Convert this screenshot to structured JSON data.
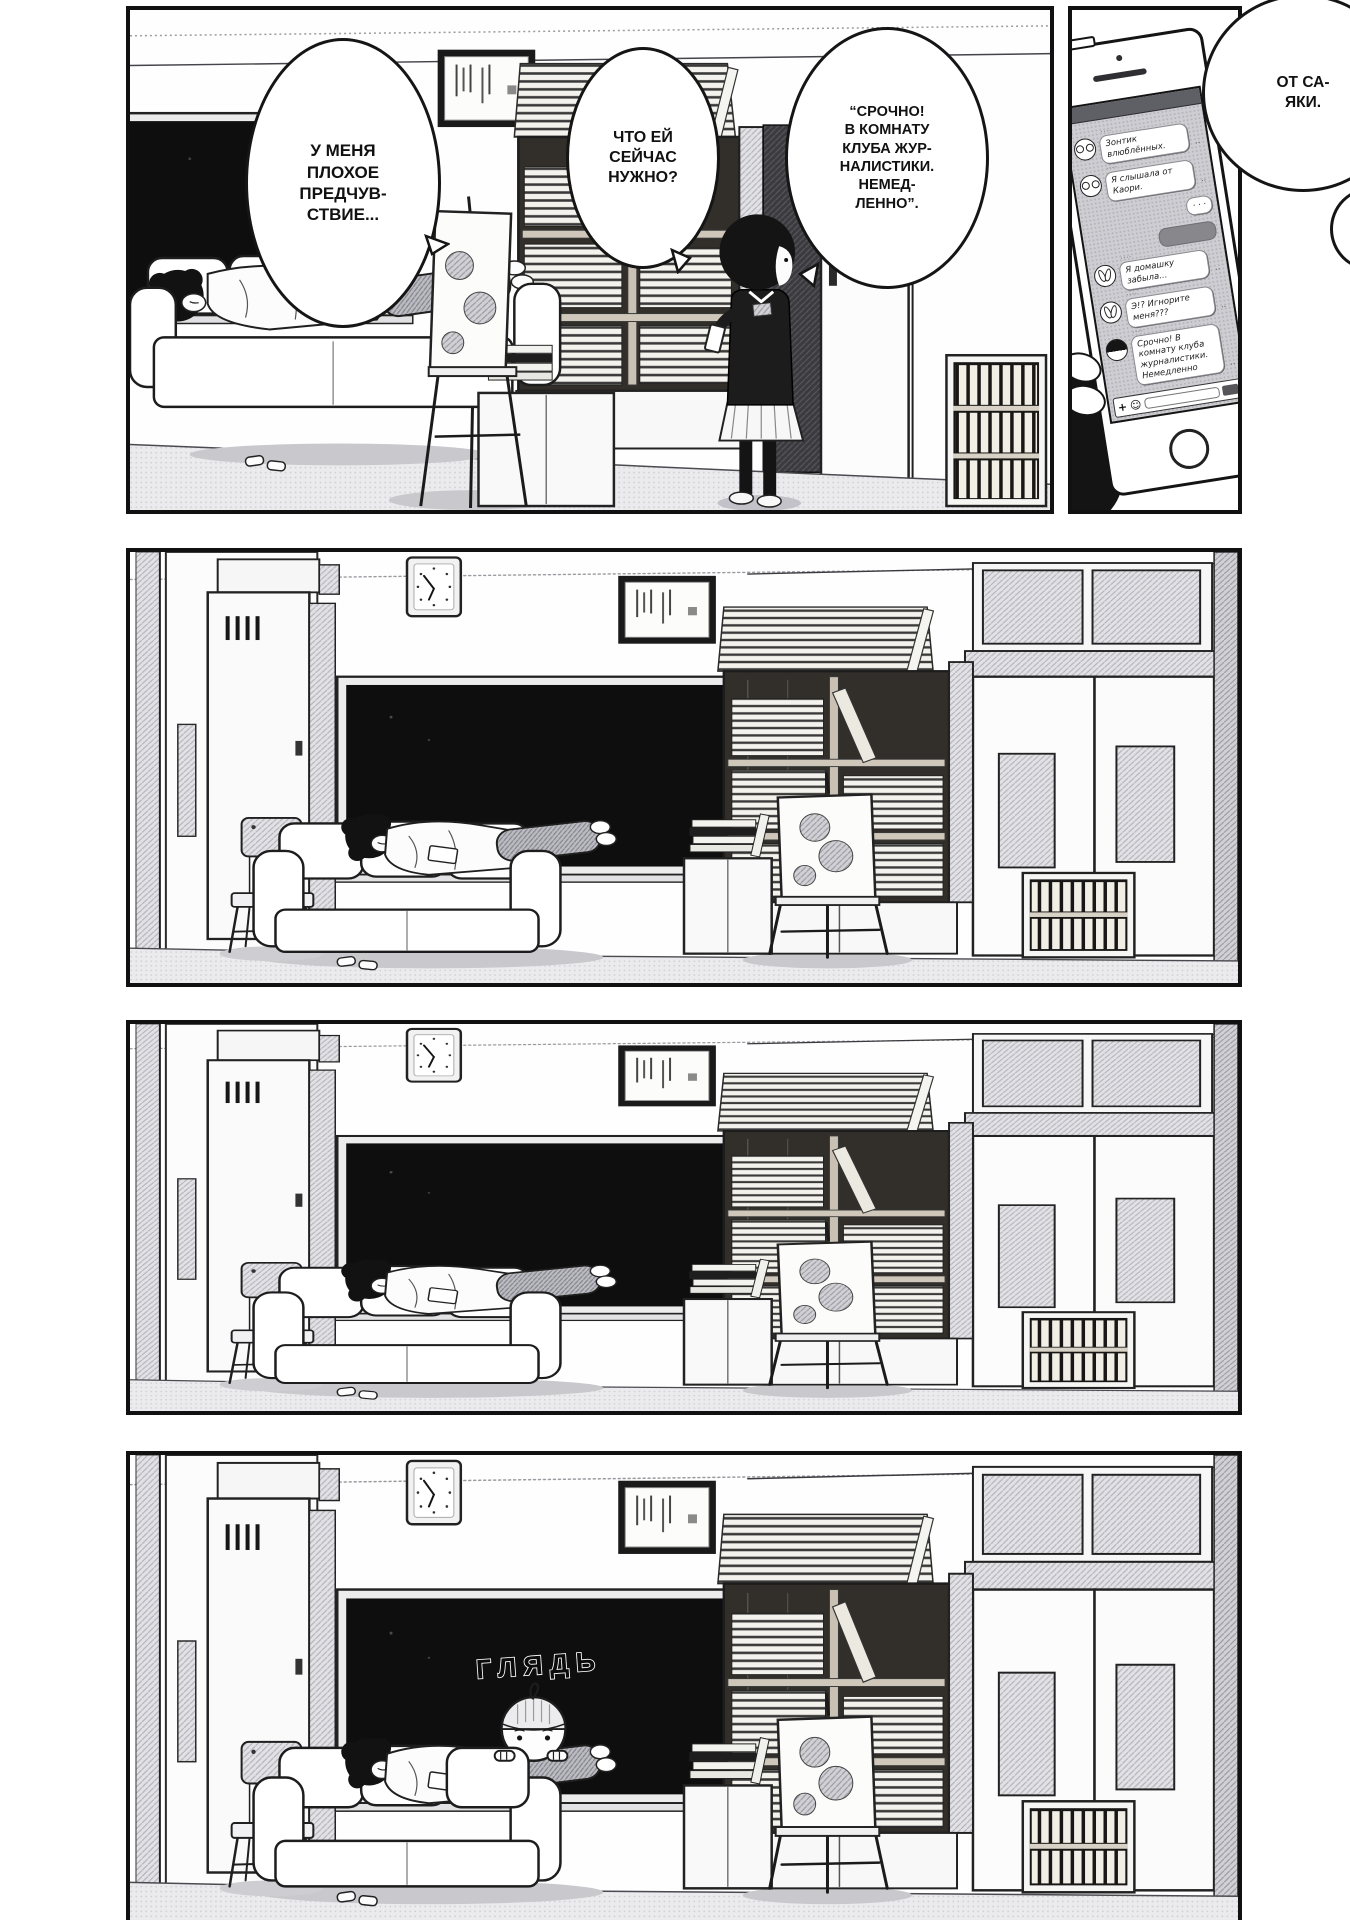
{
  "comic": {
    "bubbles": {
      "premonition": "У МЕНЯ\nПЛОХОЕ\nПРЕДЧУВ-\nСТВИЕ...",
      "what_does_she_need": "ЧТО ЕЙ\nСЕЙЧАС\nНУЖНО?",
      "urgent_message_quote": "“СРОЧНО!\nВ КОМНАТУ\nКЛУБА ЖУР-\nНАЛИСТИКИ.\nНЕМЕД-\nЛЕННО”.",
      "from_sayaka": "ОТ СА-\nЯКИ."
    },
    "sfx": {
      "peek": "ГЛЯДЬ"
    }
  },
  "phone": {
    "messages": [
      {
        "row_class": "msg-row left",
        "avatar_class": "avatar glasses",
        "avatar_icon": "glasses-avatar",
        "text": "Зонтик влюблённых."
      },
      {
        "row_class": "msg-row left",
        "avatar_class": "avatar glasses",
        "avatar_icon": "glasses-avatar",
        "text": "Я слышала от Каори."
      },
      {
        "row_class": "msg-row right",
        "avatar_class": "avatar hidden",
        "avatar_icon": "none",
        "text": "· · ·"
      },
      {
        "row_class": "msg-row right redacted",
        "avatar_class": "avatar hidden",
        "avatar_icon": "none",
        "text": ""
      },
      {
        "row_class": "msg-row left",
        "avatar_class": "avatar bunny",
        "avatar_icon": "bunny-ears-avatar",
        "text": "Я домашку забыла..."
      },
      {
        "row_class": "msg-row left",
        "avatar_class": "avatar bunny",
        "avatar_icon": "bunny-ears-avatar",
        "text": "Э!? Игнорите меня???"
      },
      {
        "row_class": "msg-row left",
        "avatar_class": "avatar darkhair",
        "avatar_icon": "dark-bob-hair-avatar",
        "text": "Срочно! В комнату клуба журналистики. Немедленно"
      }
    ],
    "composer": {
      "plus": "+",
      "emoji": "☺"
    }
  },
  "colors": {
    "ink": "#141414",
    "paper": "#ffffff",
    "halftone": "#cdcdd2"
  }
}
